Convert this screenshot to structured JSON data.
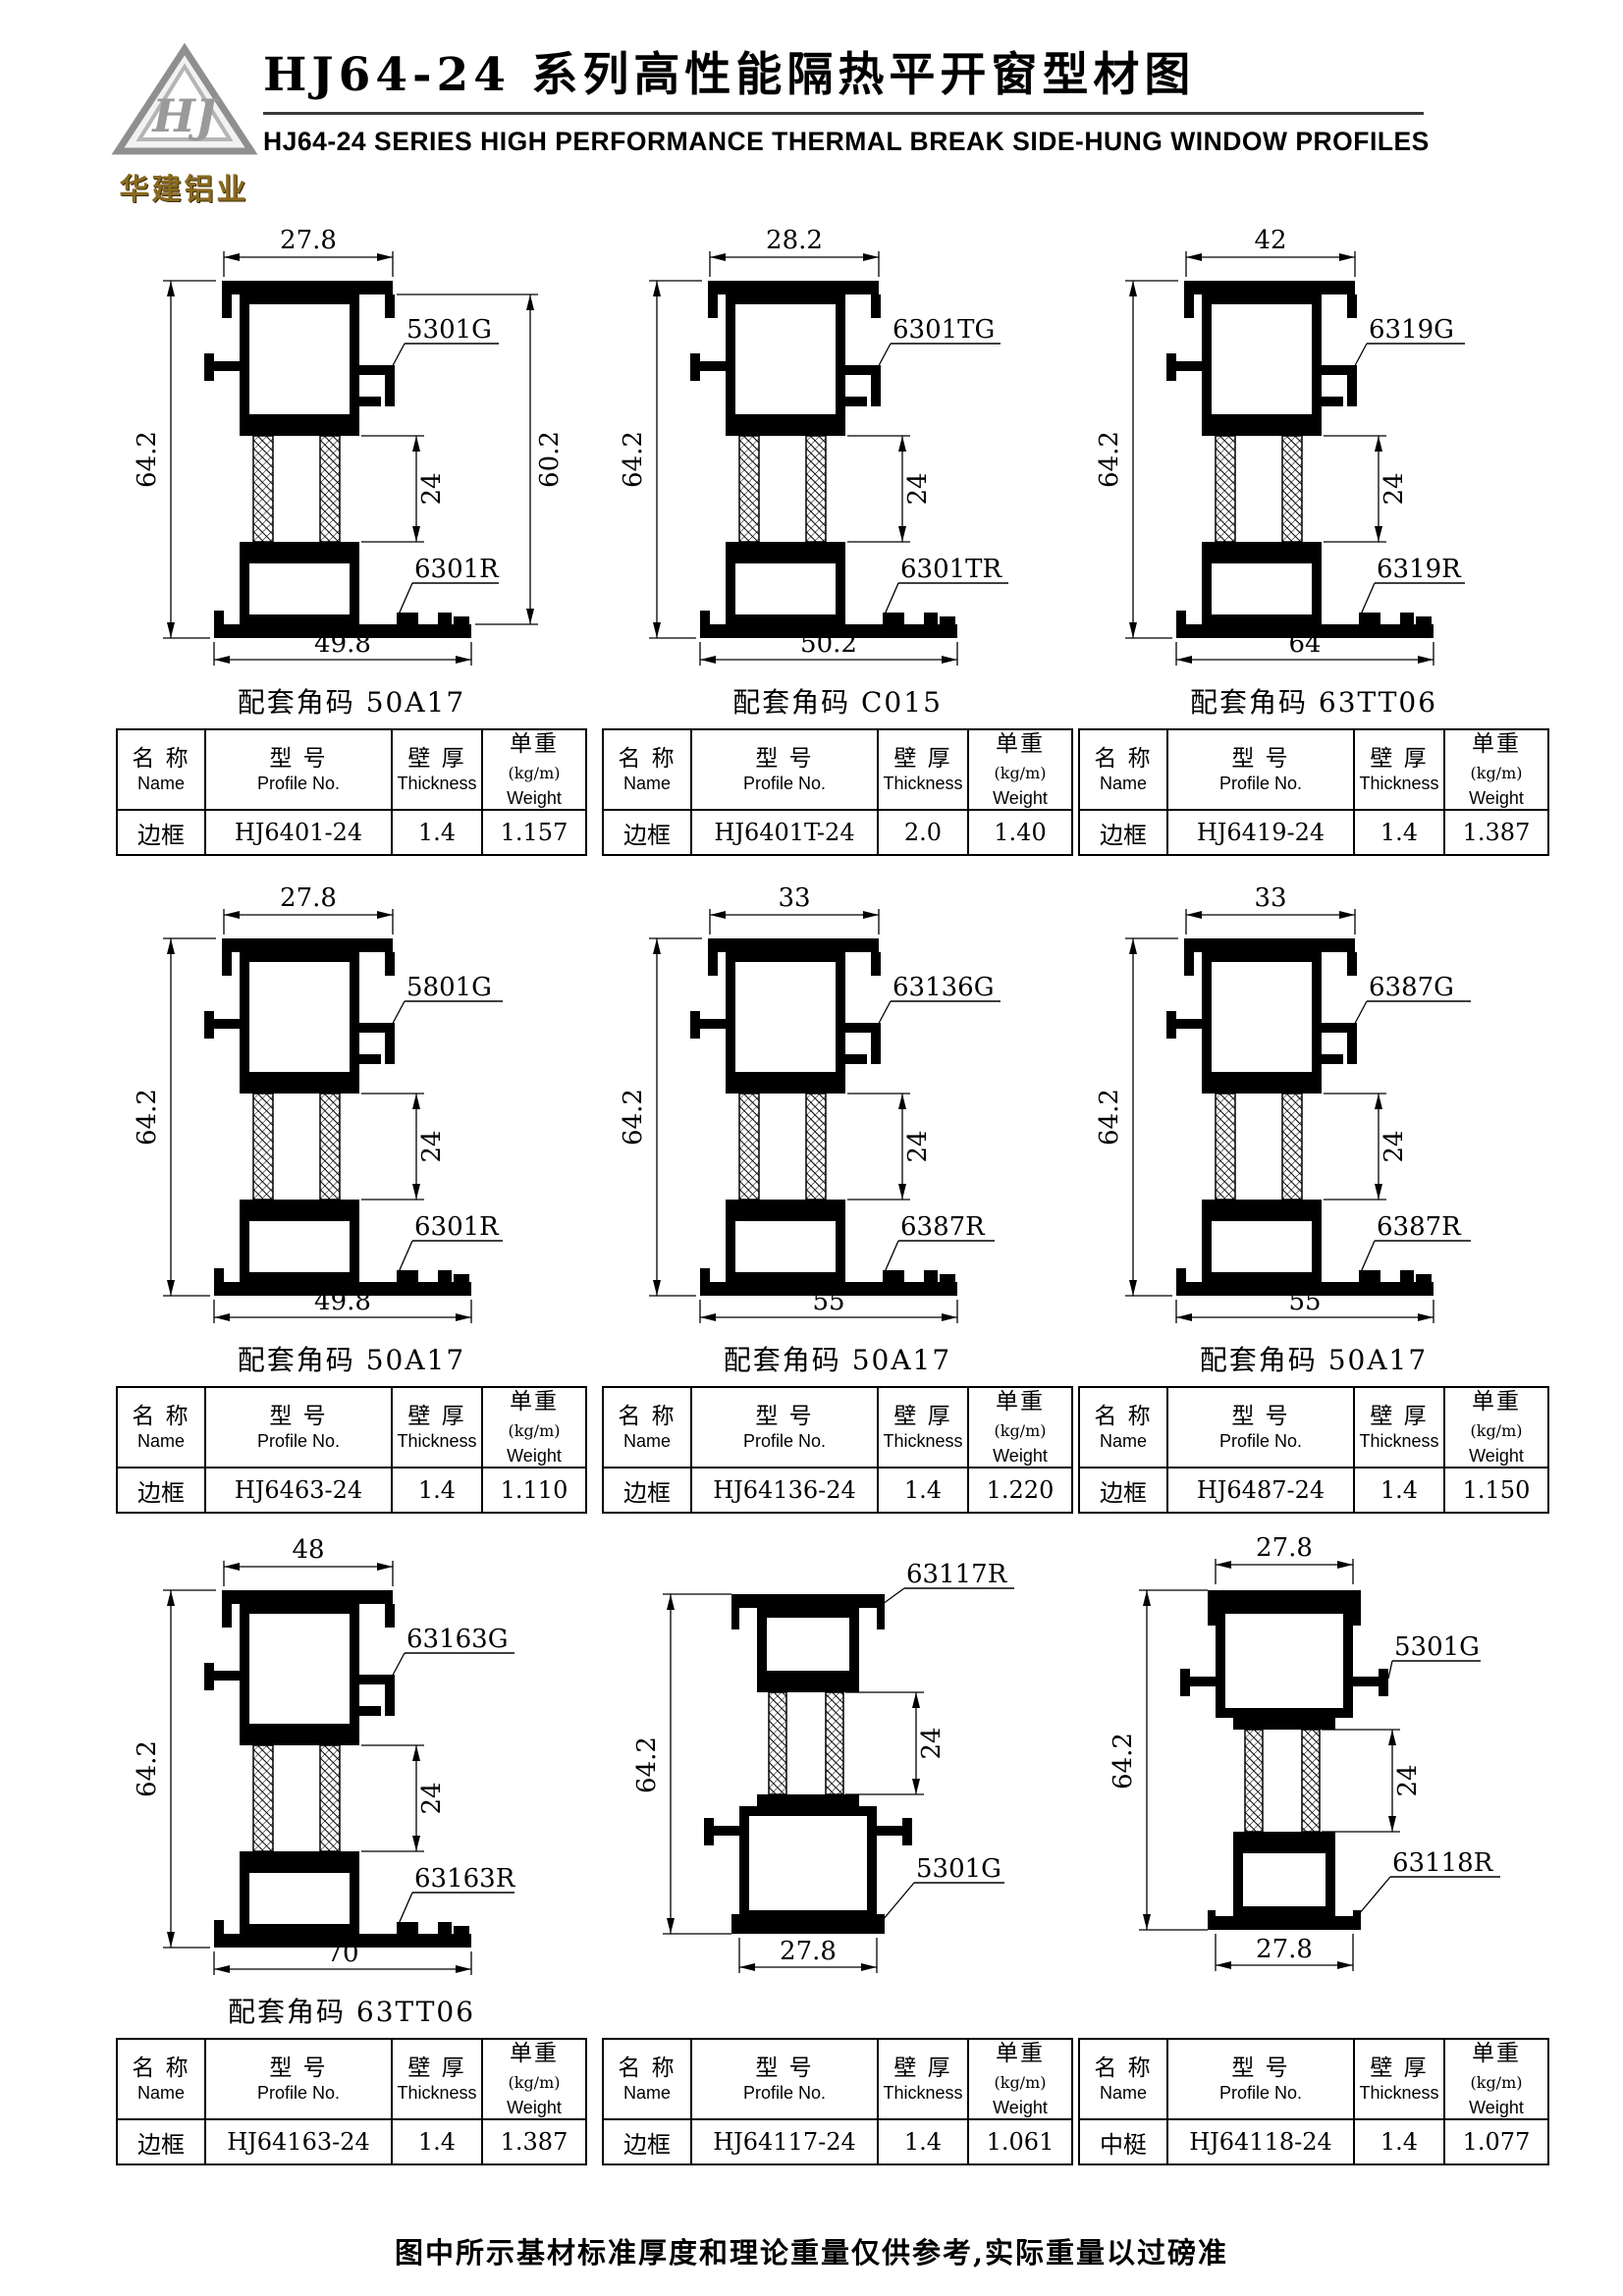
{
  "header": {
    "logo_monogram": "HJ",
    "company_name": "华建铝业",
    "title_cn": "HJ64-24 系列高性能隔热平开窗型材图",
    "title_en": "HJ64-24  SERIES  HIGH PERFORMANCE THERMAL BREAK SIDE-HUNG  WINDOW  PROFILES"
  },
  "colors": {
    "logo_gold": "#8a6a20",
    "ink": "#000000"
  },
  "table_headers": {
    "name_cn": "名 称",
    "name_en": "Name",
    "model_cn": "型 号",
    "model_en": "Profile No.",
    "thickness_cn": "壁 厚",
    "thickness_en": "Thickness",
    "weight_cn": "单重",
    "weight_unit": "(kg/m)",
    "weight_en": "Weight"
  },
  "profiles": [
    {
      "variant": "frame",
      "caption": "配套角码 50A17",
      "dims": {
        "top": "27.8",
        "left": "64.2",
        "right": "60.2",
        "mid": "24",
        "bottom": "49.8"
      },
      "labels": {
        "upper": "5301G",
        "lower": "6301R"
      },
      "row": {
        "name": "边框",
        "model": "HJ6401-24",
        "thickness": "1.4",
        "weight": "1.157"
      }
    },
    {
      "variant": "frame",
      "caption": "配套角码 C015",
      "dims": {
        "top": "28.2",
        "left": "64.2",
        "mid": "24",
        "bottom": "50.2"
      },
      "labels": {
        "upper": "6301TG",
        "lower": "6301TR"
      },
      "row": {
        "name": "边框",
        "model": "HJ6401T-24",
        "thickness": "2.0",
        "weight": "1.40"
      }
    },
    {
      "variant": "frame",
      "caption": "配套角码 63TT06",
      "dims": {
        "top": "42",
        "left": "64.2",
        "mid": "24",
        "bottom": "64"
      },
      "labels": {
        "upper": "6319G",
        "lower": "6319R"
      },
      "row": {
        "name": "边框",
        "model": "HJ6419-24",
        "thickness": "1.4",
        "weight": "1.387"
      }
    },
    {
      "variant": "frame",
      "caption": "配套角码 50A17",
      "dims": {
        "top": "27.8",
        "left": "64.2",
        "mid": "24",
        "bottom": "49.8"
      },
      "labels": {
        "upper": "5801G",
        "lower": "6301R"
      },
      "row": {
        "name": "边框",
        "model": "HJ6463-24",
        "thickness": "1.4",
        "weight": "1.110"
      }
    },
    {
      "variant": "frame",
      "caption": "配套角码 50A17",
      "dims": {
        "top": "33",
        "left": "64.2",
        "mid": "24",
        "bottom": "55"
      },
      "labels": {
        "upper": "63136G",
        "lower": "6387R"
      },
      "row": {
        "name": "边框",
        "model": "HJ64136-24",
        "thickness": "1.4",
        "weight": "1.220"
      }
    },
    {
      "variant": "frame",
      "caption": "配套角码 50A17",
      "dims": {
        "top": "33",
        "left": "64.2",
        "mid": "24",
        "bottom": "55"
      },
      "labels": {
        "upper": "6387G",
        "lower": "6387R"
      },
      "row": {
        "name": "边框",
        "model": "HJ6487-24",
        "thickness": "1.4",
        "weight": "1.150"
      }
    },
    {
      "variant": "frame",
      "caption": "配套角码 63TT06",
      "dims": {
        "top": "48",
        "left": "64.2",
        "mid": "24",
        "bottom": "70"
      },
      "labels": {
        "upper": "63163G",
        "lower": "63163R"
      },
      "row": {
        "name": "边框",
        "model": "HJ64163-24",
        "thickness": "1.4",
        "weight": "1.387"
      }
    },
    {
      "variant": "mullion-small-top",
      "caption": "",
      "dims": {
        "left": "64.2",
        "mid": "24",
        "bottom": "27.8"
      },
      "labels": {
        "upper": "63117R",
        "lower": "5301G"
      },
      "row": {
        "name": "边框",
        "model": "HJ64117-24",
        "thickness": "1.4",
        "weight": "1.061"
      }
    },
    {
      "variant": "mullion-large-top",
      "caption": "",
      "dims": {
        "top": "27.8",
        "left": "64.2",
        "mid": "24",
        "bottom": "27.8"
      },
      "labels": {
        "upper": "5301G",
        "lower": "63118R"
      },
      "row": {
        "name": "中梃",
        "model": "HJ64118-24",
        "thickness": "1.4",
        "weight": "1.077"
      }
    }
  ],
  "footer": {
    "note": "图中所示基材标准厚度和理论重量仅供参考,实际重量以过磅准"
  }
}
